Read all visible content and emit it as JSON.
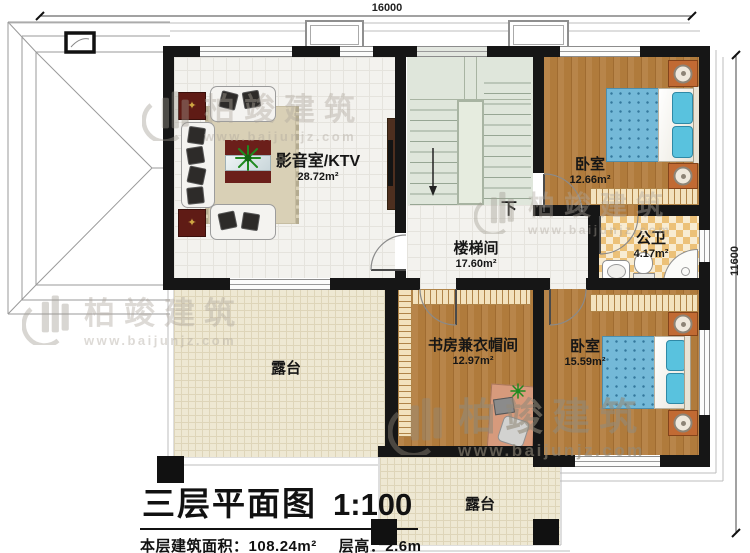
{
  "plan": {
    "dimensions": {
      "top_width_mm": "16000",
      "right_height_mm": "11600"
    },
    "rooms": [
      {
        "name": "影音室/KTV",
        "area": "28.72m²"
      },
      {
        "name": "卧室",
        "area": "12.66m²"
      },
      {
        "name": "楼梯间",
        "area": "17.60m²"
      },
      {
        "name": "公卫",
        "area": "4.17m²"
      },
      {
        "name": "书房兼衣帽间",
        "area": "12.97m²"
      },
      {
        "name": "卧室",
        "area": "15.59m²"
      },
      {
        "name": "露台",
        "area": ""
      },
      {
        "name": "露台",
        "area": ""
      }
    ],
    "stair_direction_label": "下"
  },
  "title_block": {
    "title": "三层平面图",
    "scale": "1:100",
    "floor_area_label": "本层建筑面积：",
    "floor_area_value": "108.24m²",
    "floor_height_label": "层高：",
    "floor_height_value": "2.6m"
  },
  "watermark": {
    "brand": "柏竣建筑",
    "url": "www.baijunjz.com"
  },
  "colors": {
    "wall": "#161616",
    "wood_floor": "#b5813f",
    "terrace": "#eee8d3",
    "stair": "#dfe6db",
    "bath_tile": "#ecc178",
    "bed_blue": "#74b9d8",
    "cabinet_red": "#5f1b15",
    "nightstand_orange": "#c16a33"
  }
}
